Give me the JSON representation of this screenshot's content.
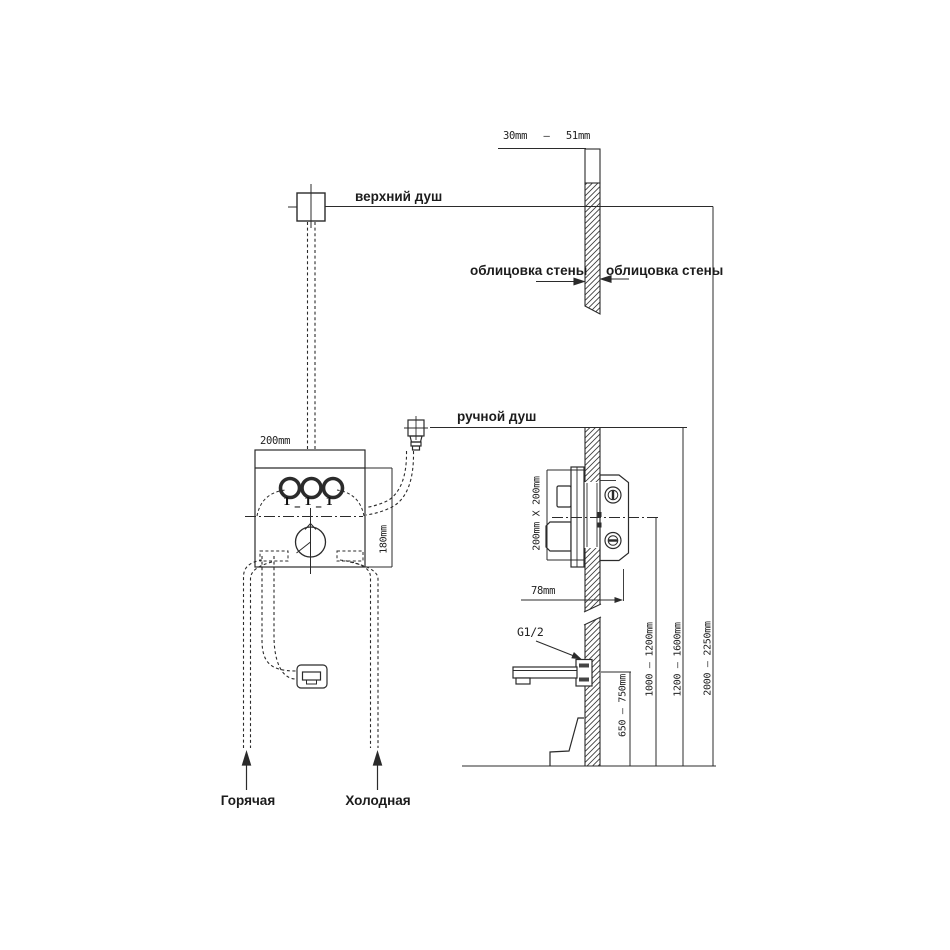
{
  "title": "Схема установки встраиваемой душевой системы",
  "labels": {
    "upper_shower": "верхний душ",
    "hand_shower": "ручной душ",
    "wall_cladding_left": "облицовка стены",
    "wall_cladding_right": "облицовка стены",
    "hot_supply": "Горячая",
    "cold_supply": "Холодная",
    "thread": "G1/2",
    "knob_marks": "1_1_1"
  },
  "dimensions": {
    "cladding_min": "30mm",
    "cladding_sep": "—",
    "cladding_max": "51mm",
    "box_width": "200mm",
    "box_height": "180mm",
    "mixer_cutout": "200mm X 200mm",
    "mixer_depth": "78mm",
    "spout_height": "650 — 750mm",
    "mixer_height": "1000 — 1200mm",
    "hand_shower_height": "1200 — 1600mm",
    "upper_shower_height": "2000 — 2250mm"
  },
  "colors": {
    "line": "#2b2b2b",
    "background": "#ffffff"
  }
}
